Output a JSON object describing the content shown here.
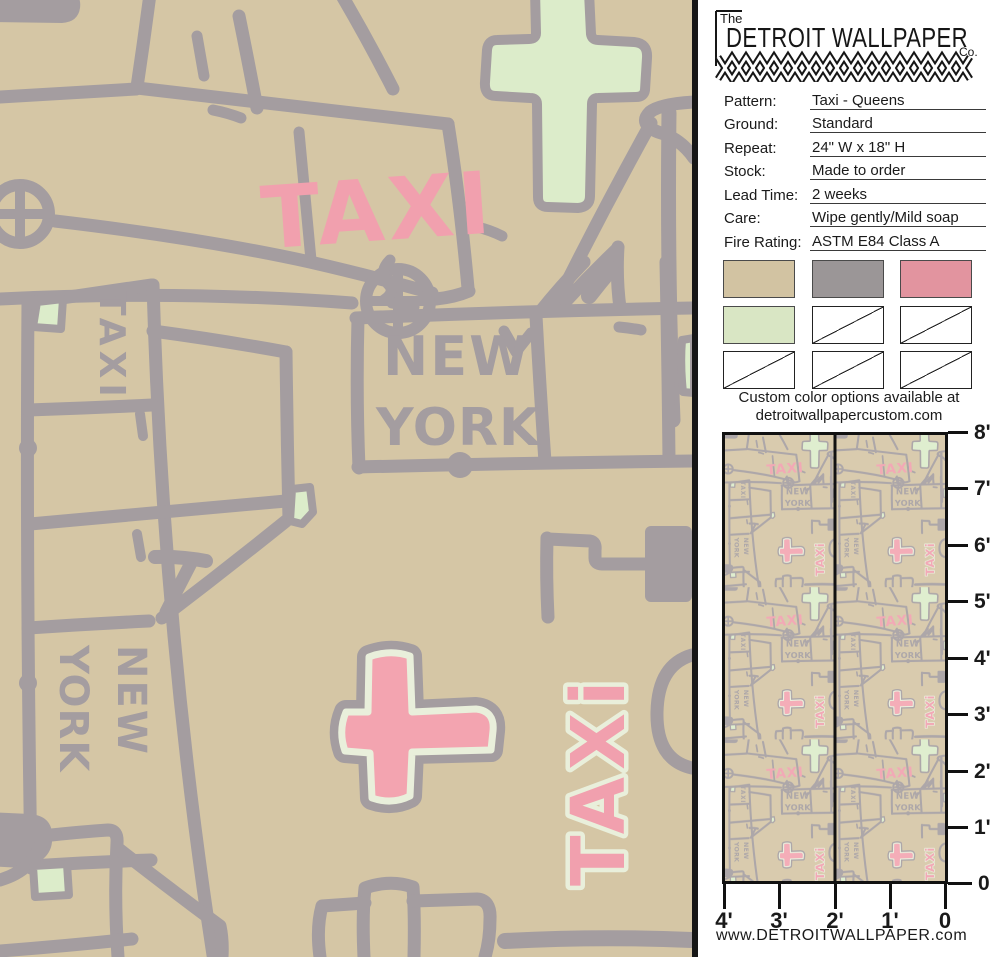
{
  "brand": {
    "prefix": "The",
    "name": "DETROIT WALLPAPER",
    "suffix": "Co."
  },
  "specs": [
    {
      "label": "Pattern:",
      "value": "Taxi - Queens"
    },
    {
      "label": "Ground:",
      "value": "Standard"
    },
    {
      "label": "Repeat:",
      "value": "24\" W x 18\" H"
    },
    {
      "label": "Stock:",
      "value": "Made to order"
    },
    {
      "label": "Lead Time:",
      "value": "2 weeks"
    },
    {
      "label": "Care:",
      "value": "Wipe gently/Mild soap"
    },
    {
      "label": "Fire Rating:",
      "value": "ASTM E84 Class A"
    }
  ],
  "swatches": {
    "cells": [
      {
        "type": "color",
        "hex": "#d2c3a2"
      },
      {
        "type": "color",
        "hex": "#9b9697"
      },
      {
        "type": "color",
        "hex": "#e2949f"
      },
      {
        "type": "color",
        "hex": "#d9e6c4"
      },
      {
        "type": "empty"
      },
      {
        "type": "empty"
      },
      {
        "type": "empty"
      },
      {
        "type": "empty"
      },
      {
        "type": "empty"
      }
    ]
  },
  "custom_note": {
    "line1": "Custom color options available at",
    "line2": "detroitwallpapercustom.com"
  },
  "scale_preview": {
    "v_ticks": [
      "8'",
      "7'",
      "6'",
      "5'",
      "4'",
      "3'",
      "2'",
      "1'",
      "0"
    ],
    "h_ticks": [
      "4'",
      "3'",
      "2'",
      "1'",
      "0"
    ]
  },
  "website": "www.DETROITWALLPAPER.com",
  "artwork": {
    "taxi_door": "TAXI",
    "taxi_van": "TAXI",
    "truck_line1": "NEW",
    "truck_line2": "YORK",
    "van_line1": "NEW",
    "van_line2": "YORK",
    "taxi_vertical": "TAXi",
    "colors": {
      "ground": "#d5c6a5",
      "line_gray": "#a49da0",
      "pink": "#f1a0ae",
      "green": "#dcecca",
      "cream": "#e9efdb"
    }
  }
}
